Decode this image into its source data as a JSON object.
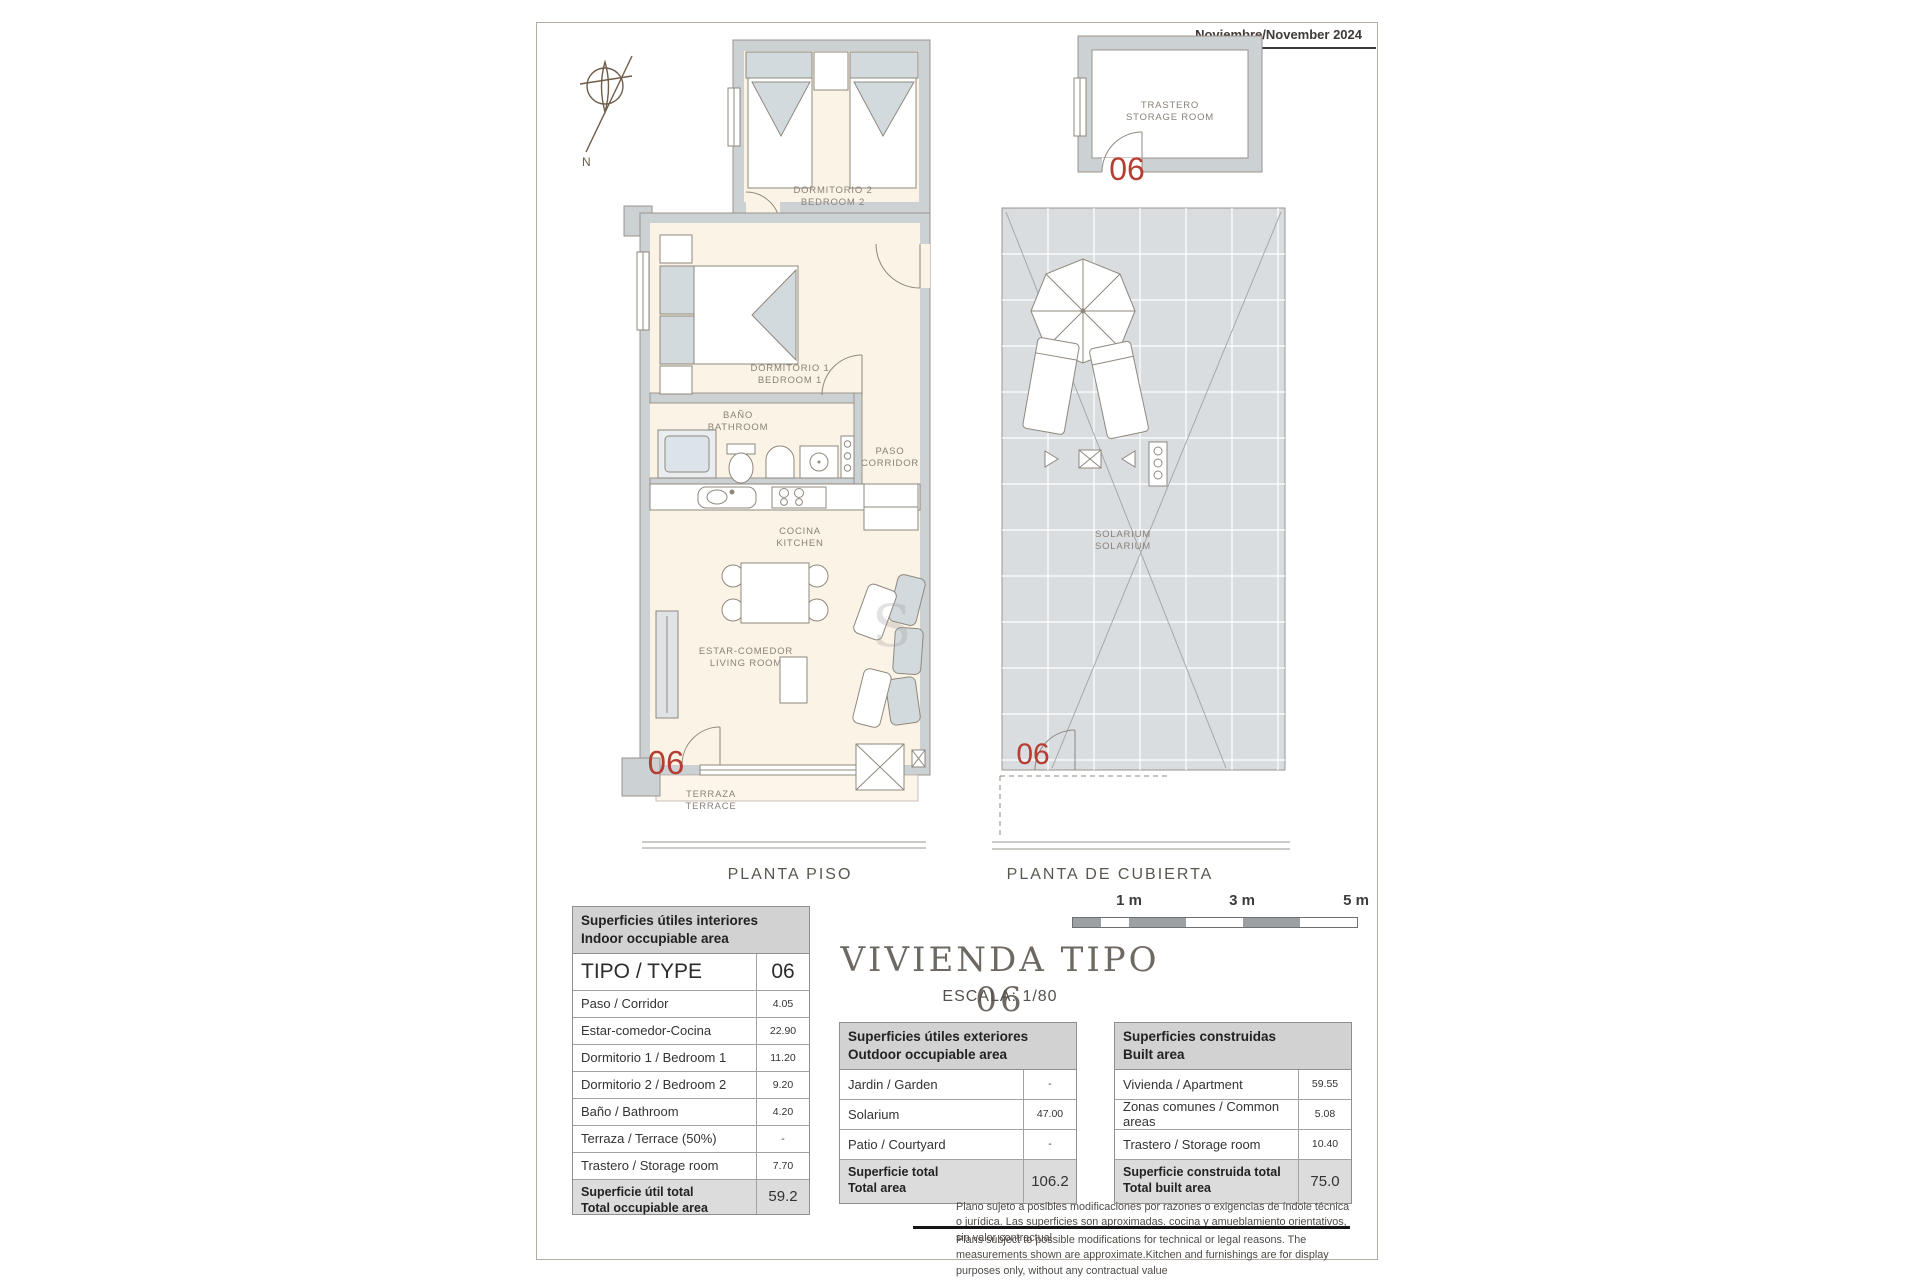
{
  "sheet": {
    "date": "Noviembre/November 2024",
    "compass_label": "N",
    "watermark": "S"
  },
  "plans": {
    "piso": {
      "caption": "PLANTA PISO",
      "unit_marker": "06",
      "labels": {
        "dormitorio2": {
          "es": "DORMITORIO 2",
          "en": "BEDROOM 2"
        },
        "dormitorio1": {
          "es": "DORMITORIO 1",
          "en": "BEDROOM 1"
        },
        "bano": {
          "es": "BAÑO",
          "en": "BATHROOM"
        },
        "paso": {
          "es": "PASO",
          "en": "CORRIDOR"
        },
        "cocina": {
          "es": "COCINA",
          "en": "KITCHEN"
        },
        "estar": {
          "es": "ESTAR-COMEDOR",
          "en": "LIVING ROOM"
        },
        "terraza": {
          "es": "TERRAZA",
          "en": "TERRACE"
        }
      }
    },
    "cubierta": {
      "caption": "PLANTA DE CUBIERTA",
      "unit_marker": "06",
      "labels": {
        "trastero": {
          "es": "TRASTERO",
          "en": "STORAGE ROOM"
        },
        "solarium": {
          "es": "SOLARIUM",
          "en": "SOLARIUM"
        }
      }
    }
  },
  "title_block": {
    "title": "VIVIENDA TIPO 06",
    "scale": "ESCALA: 1/80"
  },
  "scale_bar": {
    "labels": [
      "1 m",
      "3 m",
      "5 m"
    ]
  },
  "tables": {
    "interior": {
      "header_es": "Superficies útiles interiores",
      "header_en": "Indoor occupiable area",
      "type_label": "TIPO / TYPE",
      "type_value": "06",
      "rows": [
        {
          "label": "Paso / Corridor",
          "value": "4.05"
        },
        {
          "label": "Estar-comedor-Cocina",
          "value": "22.90"
        },
        {
          "label": "Dormitorio 1 / Bedroom 1",
          "value": "11.20"
        },
        {
          "label": "Dormitorio 2 / Bedroom 2",
          "value": "9.20"
        },
        {
          "label": "Baño / Bathroom",
          "value": "4.20"
        },
        {
          "label": "Terraza / Terrace (50%)",
          "value": "-"
        },
        {
          "label": "Trastero / Storage room",
          "value": "7.70"
        }
      ],
      "total_label_es": "Superficie útil total",
      "total_label_en": "Total occupiable area",
      "total_value": "59.2"
    },
    "exterior": {
      "header_es": "Superficies útiles exteriores",
      "header_en": "Outdoor occupiable area",
      "rows": [
        {
          "label": "Jardin / Garden",
          "value": "-"
        },
        {
          "label": "Solarium",
          "value": "47.00"
        },
        {
          "label": "Patio / Courtyard",
          "value": "-"
        }
      ],
      "total_label_es": "Superficie total",
      "total_label_en": "Total area",
      "total_value": "106.2"
    },
    "built": {
      "header_es": "Superficies construidas",
      "header_en": "Built area",
      "rows": [
        {
          "label": "Vivienda / Apartment",
          "value": "59.55"
        },
        {
          "label": "Zonas comunes / Common areas",
          "value": "5.08"
        },
        {
          "label": "Trastero / Storage room",
          "value": "10.40"
        }
      ],
      "total_label_es": "Superficie construida total",
      "total_label_en": "Total built area",
      "total_value": "75.0"
    }
  },
  "legal": {
    "es": "Plano sujeto a posibles modificaciones por razones o exigencias de índole técnica o jurídica. Las superficies son aproximadas. cocina y amueblamiento orientativos, sin valor contractual",
    "en": "Plans subject to possible modifications for technical or legal reasons. The measurements shown are approximate.Kitchen and furnishings are for display purposes only, without any contractual value"
  },
  "colors": {
    "accent_red": "#b63d32",
    "wall_gray": "#ccd1d4",
    "room_cream": "#faf3e6",
    "tile_gray": "#d9dde0",
    "table_header_bg": "#d2d2d2"
  }
}
